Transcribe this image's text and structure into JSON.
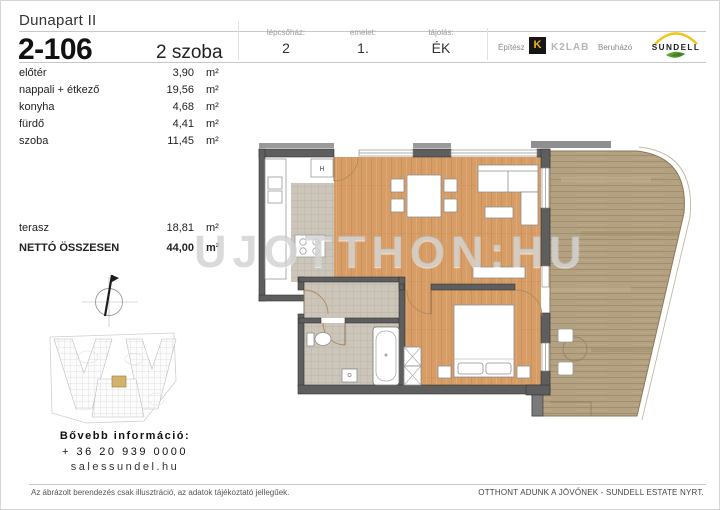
{
  "header": {
    "project_title": "Dunapart II",
    "unit_number": "2-106",
    "room_count": "2 szoba",
    "meta": [
      {
        "label": "lépcsőház:",
        "value": "2"
      },
      {
        "label": "emelet:",
        "value": "1."
      },
      {
        "label": "tájolás:",
        "value": "ÉK"
      }
    ],
    "architect": {
      "label": "Építész",
      "logo_letter": "K",
      "name": "K2LAB"
    },
    "developer": {
      "label": "Beruházó",
      "name": "SUNDELL"
    }
  },
  "area_table": {
    "rows": [
      {
        "name": "előtér",
        "value": "3,90",
        "unit": "m²"
      },
      {
        "name": "nappali + étkező",
        "value": "19,56",
        "unit": "m²"
      },
      {
        "name": "konyha",
        "value": "4,68",
        "unit": "m²"
      },
      {
        "name": "fürdő",
        "value": "4,41",
        "unit": "m²"
      },
      {
        "name": "szoba",
        "value": "11,45",
        "unit": "m²"
      }
    ],
    "terrace_row": {
      "name": "terasz",
      "value": "18,81",
      "unit": "m²"
    },
    "total_row": {
      "name": "NETTÓ ÖSSZESEN",
      "value": "44,00",
      "unit": "m²"
    }
  },
  "plan": {
    "fridge_label": "H"
  },
  "watermark": "UJOTTHON:HU",
  "contact": {
    "heading": "Bővebb információ:",
    "phone": "+ 36 20 939 0000",
    "website": "salessundel.hu"
  },
  "footer": {
    "disclaimer": "Az ábrázolt berendezés csak illusztráció, az adatok tájékoztató jellegűek.",
    "slogan": "OTTHONT ADUNK A JÖVŐNEK - SUNDELL ESTATE NYRT."
  },
  "colors": {
    "wood": "#d79d66",
    "deck": "#b3a181",
    "tile": "#ccc5b9",
    "wall": "#5e5e5e",
    "accent_yellow": "#f2b318",
    "leaf_green": "#5aa032",
    "site_highlight": "#d3b26c"
  }
}
